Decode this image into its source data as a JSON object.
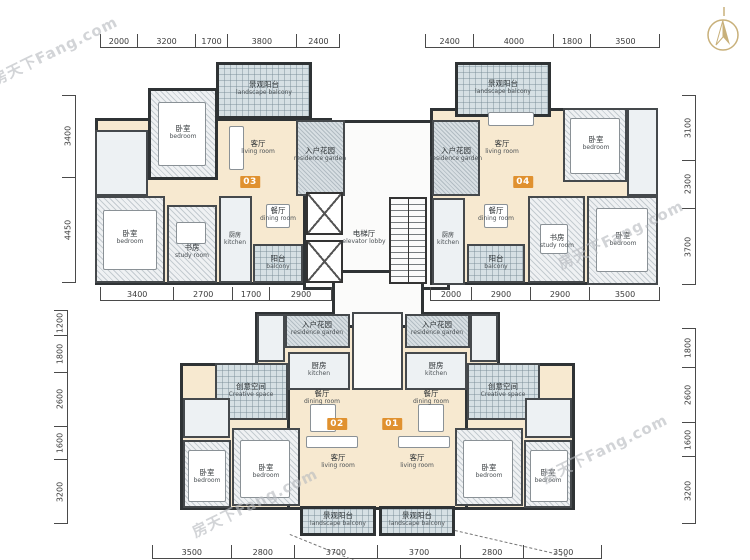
{
  "watermark": "房天下Fang.com",
  "units": {
    "u01": "01",
    "u02": "02",
    "u03": "03",
    "u04": "04"
  },
  "labels": {
    "bedroom": {
      "cn": "卧室",
      "en": "bedroom"
    },
    "living_room": {
      "cn": "客厅",
      "en": "living room"
    },
    "dining_room": {
      "cn": "餐厅",
      "en": "dining room"
    },
    "kitchen": {
      "cn": "厨房",
      "en": "kitchen"
    },
    "balcony": {
      "cn": "阳台",
      "en": "balcony"
    },
    "landscape_balcony": {
      "cn": "景观阳台",
      "en": "landscape balcony"
    },
    "residence_garden": {
      "cn": "入户花园",
      "en": "residence garden"
    },
    "creative_space": {
      "cn": "创意空间",
      "en": "Creative space"
    },
    "elevator_lobby": {
      "cn": "电梯厅",
      "en": "elevator lobby"
    },
    "study": {
      "cn": "书房",
      "en": "study room"
    },
    "bathroom": {
      "cn": "卫生间",
      "en": ""
    }
  },
  "dims": {
    "top_left": [
      "2000",
      "3200",
      "1700",
      "3800",
      "2400"
    ],
    "top_right": [
      "2400",
      "4000",
      "1800",
      "3500"
    ],
    "mid_left": [
      "3400",
      "2700",
      "1700",
      "2900"
    ],
    "mid_right": [
      "2000",
      "2900",
      "2900",
      "3500"
    ],
    "bottom": [
      "3500",
      "2800",
      "3700",
      "3700",
      "2800",
      "3500"
    ],
    "left_upper": [
      "3400",
      "4450"
    ],
    "left_lower": [
      "1200",
      "1800",
      "2600",
      "1600",
      "3200"
    ],
    "right_upper": [
      "3100",
      "2300",
      "3700"
    ],
    "right_lower": [
      "1800",
      "2600",
      "1600",
      "3200"
    ]
  },
  "colors": {
    "accent_orange": "#e0912f",
    "wall": "#2f3335",
    "cream": "#f7e9d0",
    "gold": "#c8b07a"
  }
}
